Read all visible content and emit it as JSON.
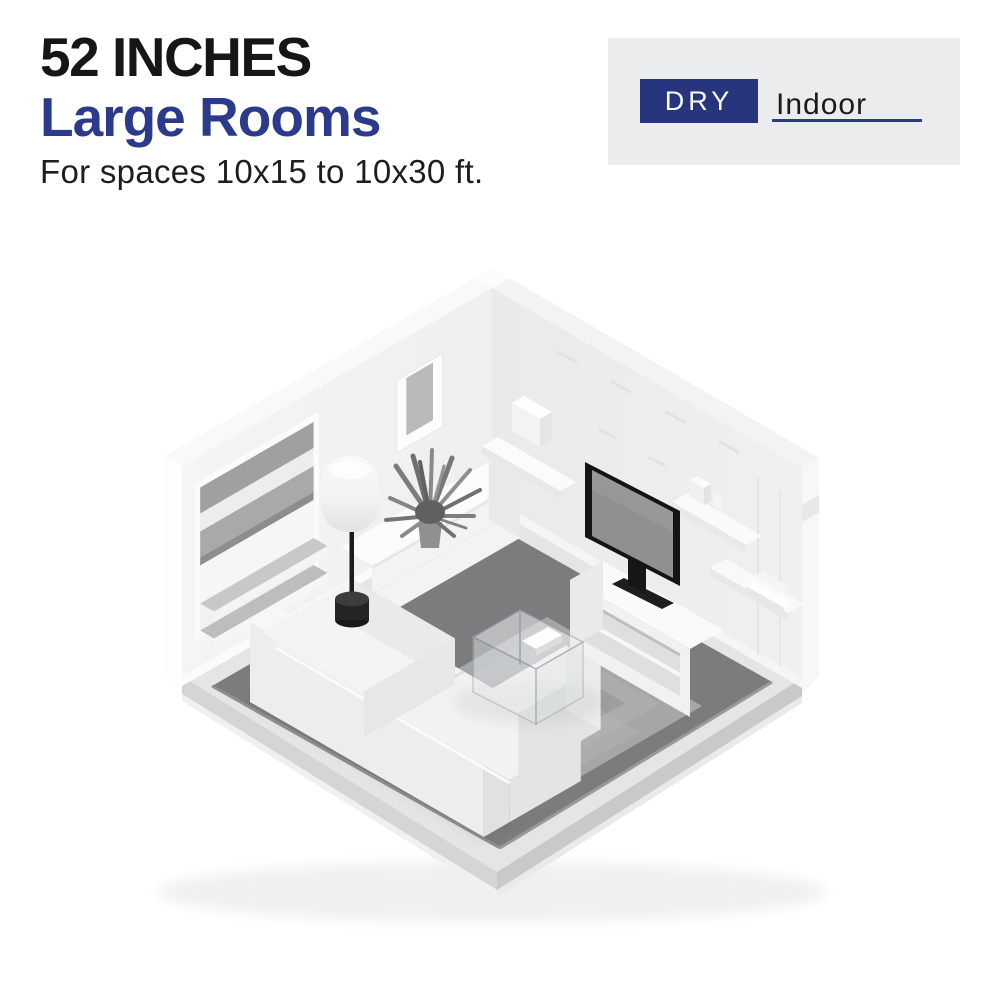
{
  "header": {
    "size_label": "52 INCHES",
    "room_label": "Large Rooms",
    "subtitle": "For spaces 10x15 to 10x30 ft."
  },
  "badge": {
    "rating": "DRY",
    "location": "Indoor"
  },
  "colors": {
    "accent_navy": "#2b3a8a",
    "badge_navy": "#26357e",
    "panel_gray": "#ebecee",
    "text_black": "#161616",
    "rug_gray": "#7b7c7e",
    "wall_left": "#f1f2f2",
    "wall_right": "#ebeced",
    "floor_gray": "#e4e5e5"
  }
}
